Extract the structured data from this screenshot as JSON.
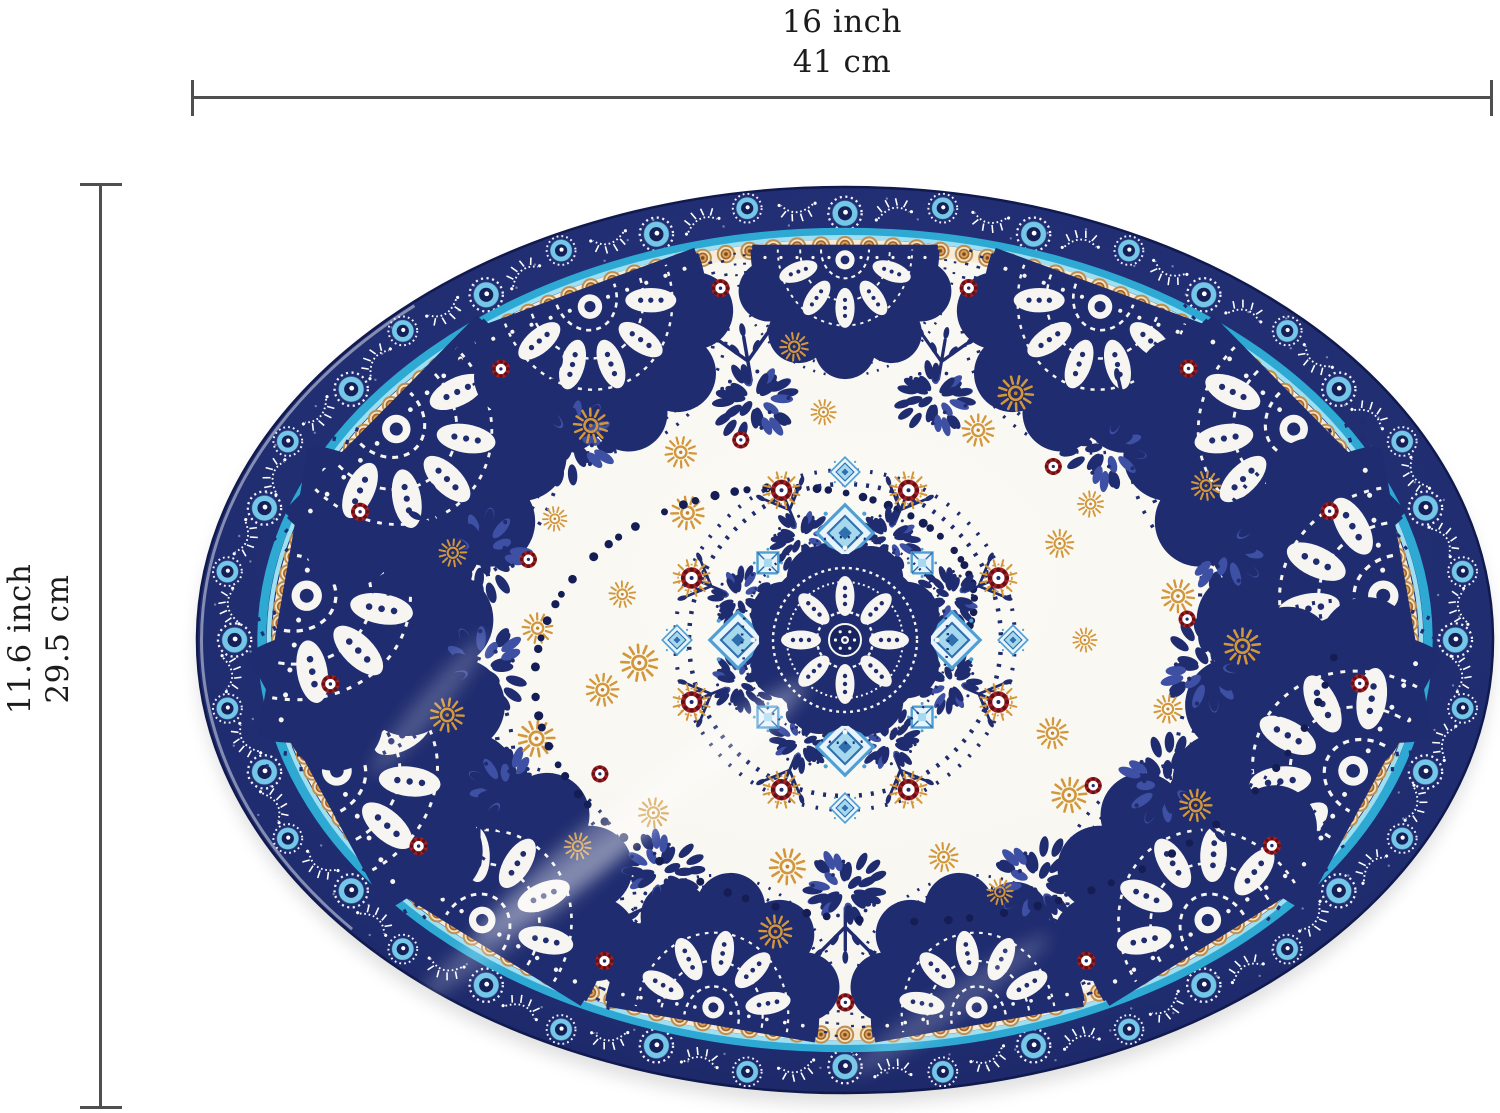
{
  "figure": {
    "background_color": "#ffffff",
    "line_color": "#4f4f4f",
    "text_color": "#1c1c1c",
    "width_annotation": {
      "imperial": "16 inch",
      "metric": "41 cm"
    },
    "height_annotation": {
      "imperial": "11.6 inch",
      "metric": "29.5 cm"
    }
  },
  "plate": {
    "colors": {
      "navy": "#1f2c6f",
      "navy_dark": "#101a4e",
      "navy_mid": "#2a3a82",
      "navy_light": "#3e50a4",
      "dot_navy": "#141e55",
      "sky": "#74c7e6",
      "cyan_ring": "#2ea9d4",
      "cyan_light": "#9edff2",
      "cream": "#f4ecd9",
      "bead_ring": "#c08d4e",
      "bead_fill": "#f2e4c2",
      "bead_mid": "#d9a35c",
      "bead_center": "#7d4a1e",
      "field_white": "#f8f6f0",
      "orange": "#d3973b",
      "orange_deep": "#bf7f2c",
      "red": "#a51f24",
      "red_dark": "#631016",
      "diamond_stroke": "#4f9fd4",
      "diamond_mid": "#2f6fae",
      "diamond_fill": "#a6d8ee",
      "diamond_pale": "#e8f4fb",
      "white": "#f6f5f1"
    }
  }
}
